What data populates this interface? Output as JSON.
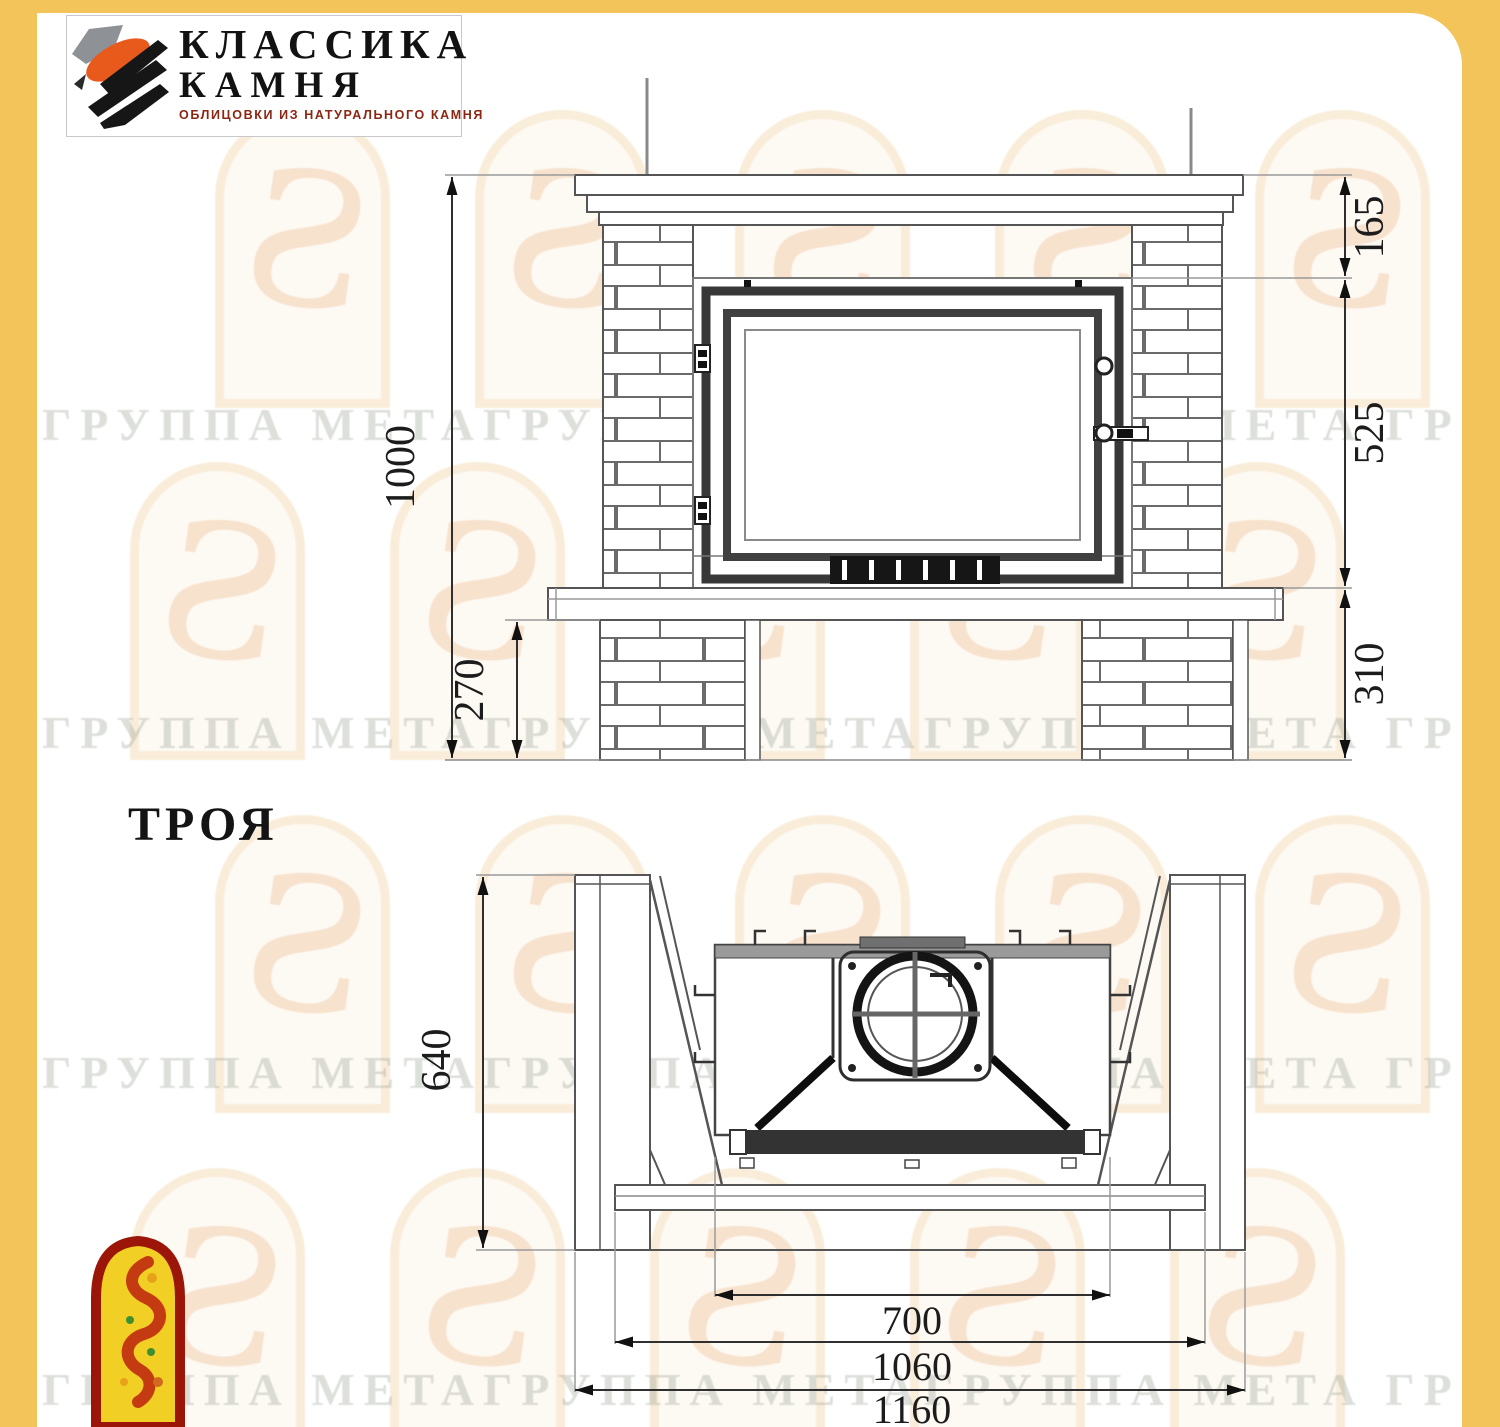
{
  "page": {
    "frame_color": "#f2c45a",
    "canvas_color": "#ffffff"
  },
  "logo": {
    "title_line1": "КЛАССИКА",
    "title_line2": "КАМНЯ",
    "subtitle": "ОБЛИЦОВКИ ИЗ НАТУРАЛЬНОГО КАМНЯ"
  },
  "watermark": {
    "text": "ГРУППА МЕТАГРУППА МЕТАГРУППА МЕТА ГРУППА"
  },
  "model": {
    "name": "ТРОЯ"
  },
  "front_view": {
    "dims": {
      "total_height": "1000",
      "mantel_height": "165",
      "firebox_height": "525",
      "base_height": "310",
      "plinth_height": "270"
    }
  },
  "plan_view": {
    "dims": {
      "depth": "640",
      "firebox_width": "700",
      "body_width": "1060",
      "total_width": "1160"
    }
  }
}
